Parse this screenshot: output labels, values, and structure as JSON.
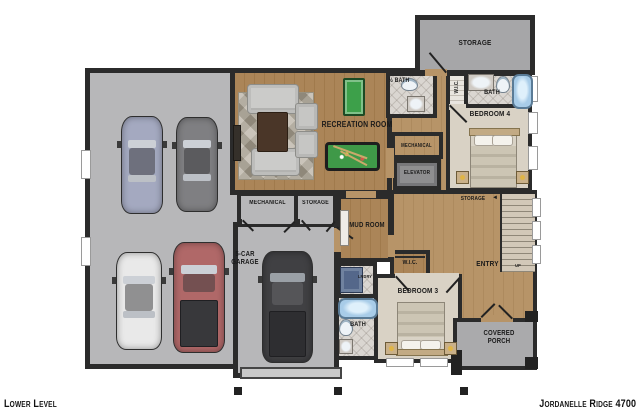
{
  "footer": {
    "level_label": "Lower Level",
    "plan_name": "Jordanelle Ridge 4700"
  },
  "rooms": {
    "recreation_room": "RECREATION ROOM",
    "garage": "5-CAR GARAGE",
    "storage_upper": "STORAGE",
    "half_bath": "½ BATH",
    "wic_bedroom4": "W.I.C.",
    "bath_bedroom4": "BATH",
    "bedroom4": "BEDROOM 4",
    "mechanical_hall": "MECHANICAL",
    "elevator": "ELEVATOR",
    "mechanical_garage": "MECHANICAL",
    "storage_garage": "STORAGE",
    "mud_room": "MUD ROOM",
    "storage_understairs": "STORAGE",
    "entry": "ENTRY",
    "stairs_direction": "UP",
    "wic_bedroom3": "W.I.C.",
    "laundry": "LNDRY",
    "bedroom3": "BEDROOM 3",
    "bath_bedroom3": "BATH",
    "covered_porch": "COVERED PORCH"
  },
  "icons": {
    "storage_access_arrow": "◄"
  },
  "vehicles": [
    {
      "name": "sedan-silver-blue",
      "color": "#a4a9c0"
    },
    {
      "name": "sedan-gray",
      "color": "#7f7f82"
    },
    {
      "name": "sedan-white",
      "color": "#e9e9e9"
    },
    {
      "name": "pickup-red",
      "color": "#b06868"
    },
    {
      "name": "suv-black",
      "color": "#404043"
    }
  ],
  "colors": {
    "wall": "#2b2b2b",
    "wood_floor": "#ab8558",
    "wood_floor_light": "#b79468",
    "garage_floor": "#b7b7b9",
    "storage_floor": "#a6a6a8",
    "porch_floor": "#aaaaac",
    "carpet": "#d9d2c5",
    "tile": "#dad6d1",
    "elevator_floor": "#8e8e90",
    "fixture_blue": "#a8cce8",
    "pool_table_green": "#3f9948",
    "game_board_green": "#3da04a",
    "label_ink": "#1a1a1a"
  }
}
